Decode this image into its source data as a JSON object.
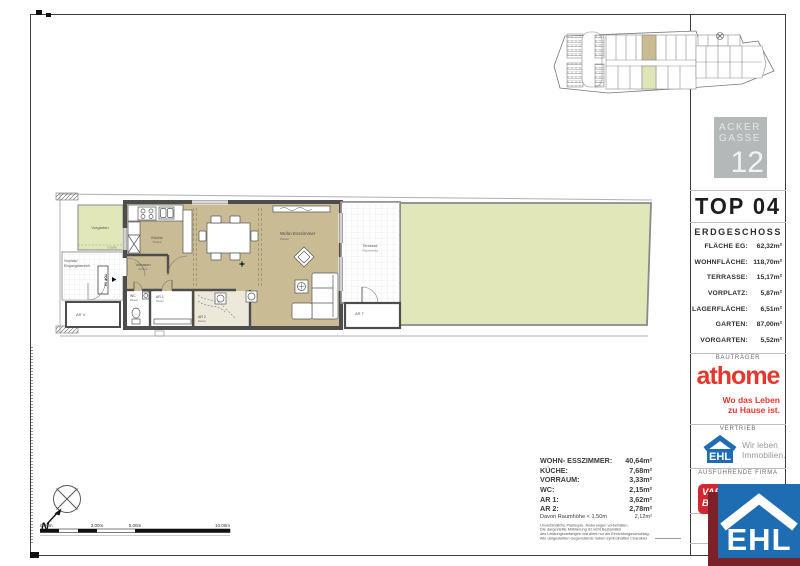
{
  "panel": {
    "project": {
      "name_line1": "ACKER",
      "name_line2": "GASSE",
      "number": "12"
    },
    "unit_title": "TOP 04",
    "floor_label": "ERDGESCHOSS",
    "areas": [
      {
        "label": "FLÄCHE EG:",
        "value": "62,32m²"
      },
      {
        "label": "WOHNFLÄCHE:",
        "value": "118,70m²"
      },
      {
        "label": "TERRASSE:",
        "value": "15,17m²"
      },
      {
        "label": "VORPLATZ:",
        "value": "5,87m²"
      },
      {
        "label": "LAGERFLÄCHE:",
        "value": "6,51m²"
      },
      {
        "label": "GARTEN:",
        "value": "87,00m²"
      },
      {
        "label": "VORGARTEN:",
        "value": "5,52m²"
      }
    ],
    "sections": {
      "developer_heading": "BAUTRÄGER",
      "sales_heading": "VERTRIEB",
      "contractor_heading": "AUSFÜHRENDE FIRMA"
    },
    "athome": {
      "wordmark": "athome",
      "tagline_line1": "Wo das Leben",
      "tagline_line2": "zu Hause ist."
    },
    "ehl": {
      "wordmark": "EHL",
      "tagline_line1": "Wir leben",
      "tagline_line2": "Immobilien."
    },
    "vario": {
      "line1": "VARIO",
      "line2": "BAU"
    },
    "scale_abbrev": "M"
  },
  "rooms_list": {
    "items": [
      {
        "label": "WOHN- ESSZIMMER:",
        "value": "40,64m²"
      },
      {
        "label": "KÜCHE:",
        "value": "7,68m²"
      },
      {
        "label": "VORRAUM:",
        "value": "3,33m²"
      },
      {
        "label": "WC:",
        "value": "2,15m²"
      },
      {
        "label": "AR 1:",
        "value": "3,62m²"
      },
      {
        "label": "AR 2:",
        "value": "2,78m²"
      }
    ],
    "note_label": "Davon Raumhöhe < 1.50m",
    "note_value": "2,12m²",
    "disclaimer": [
      "Unverbindliche Plankopie. Änderungen vorbehalten.",
      "Die dargestellte Möblierung ist nicht Bestandteil",
      "des Leistungsumfanges und dient nur als Einrichtungsvorschlag.",
      "Alle dargestellten Gegenstände haben symbolhaften Charakter."
    ]
  },
  "plan": {
    "rooms": {
      "vorgarten": "Vorgarten",
      "stufe": "STUFE",
      "vorplatz_line1": "Vorplatz/",
      "vorplatz_line2": "Eingangsbereich",
      "top_label": "TOP 04",
      "arv": "AR V",
      "kueche": "Küche",
      "kueche_sub": "Parkett",
      "vorraum": "Vorraum",
      "vorraum_sub": "Parkett",
      "wc": "WC",
      "wc_sub": "Fliesen",
      "ar1": "AR 1",
      "ar1_sub": "Fliesen",
      "ar2": "AR 2",
      "ar2_sub": "Fliesen",
      "wohn": "Wohn-Esszimmer",
      "wohn_sub": "Parkett",
      "terrasse": "Terrasse",
      "terrasse_sub": "Plattenbelag",
      "art": "AR T"
    }
  },
  "scalebar": {
    "tick0": "0.00m",
    "tick1": "3.00m",
    "tick2": "5.00m",
    "tick3": "10.00m"
  },
  "compass": {
    "north_label": "N"
  },
  "colors": {
    "brand_red": "#e6352b",
    "ehl_blue": "#1e6cb2",
    "maroon": "#7c2128",
    "vario_red": "#d22730",
    "floor_tan": "#c9bb94",
    "garden_green": "#e2e7ba",
    "wall_gray": "#4d4d4d",
    "badge_gray": "#b4b8b9"
  }
}
